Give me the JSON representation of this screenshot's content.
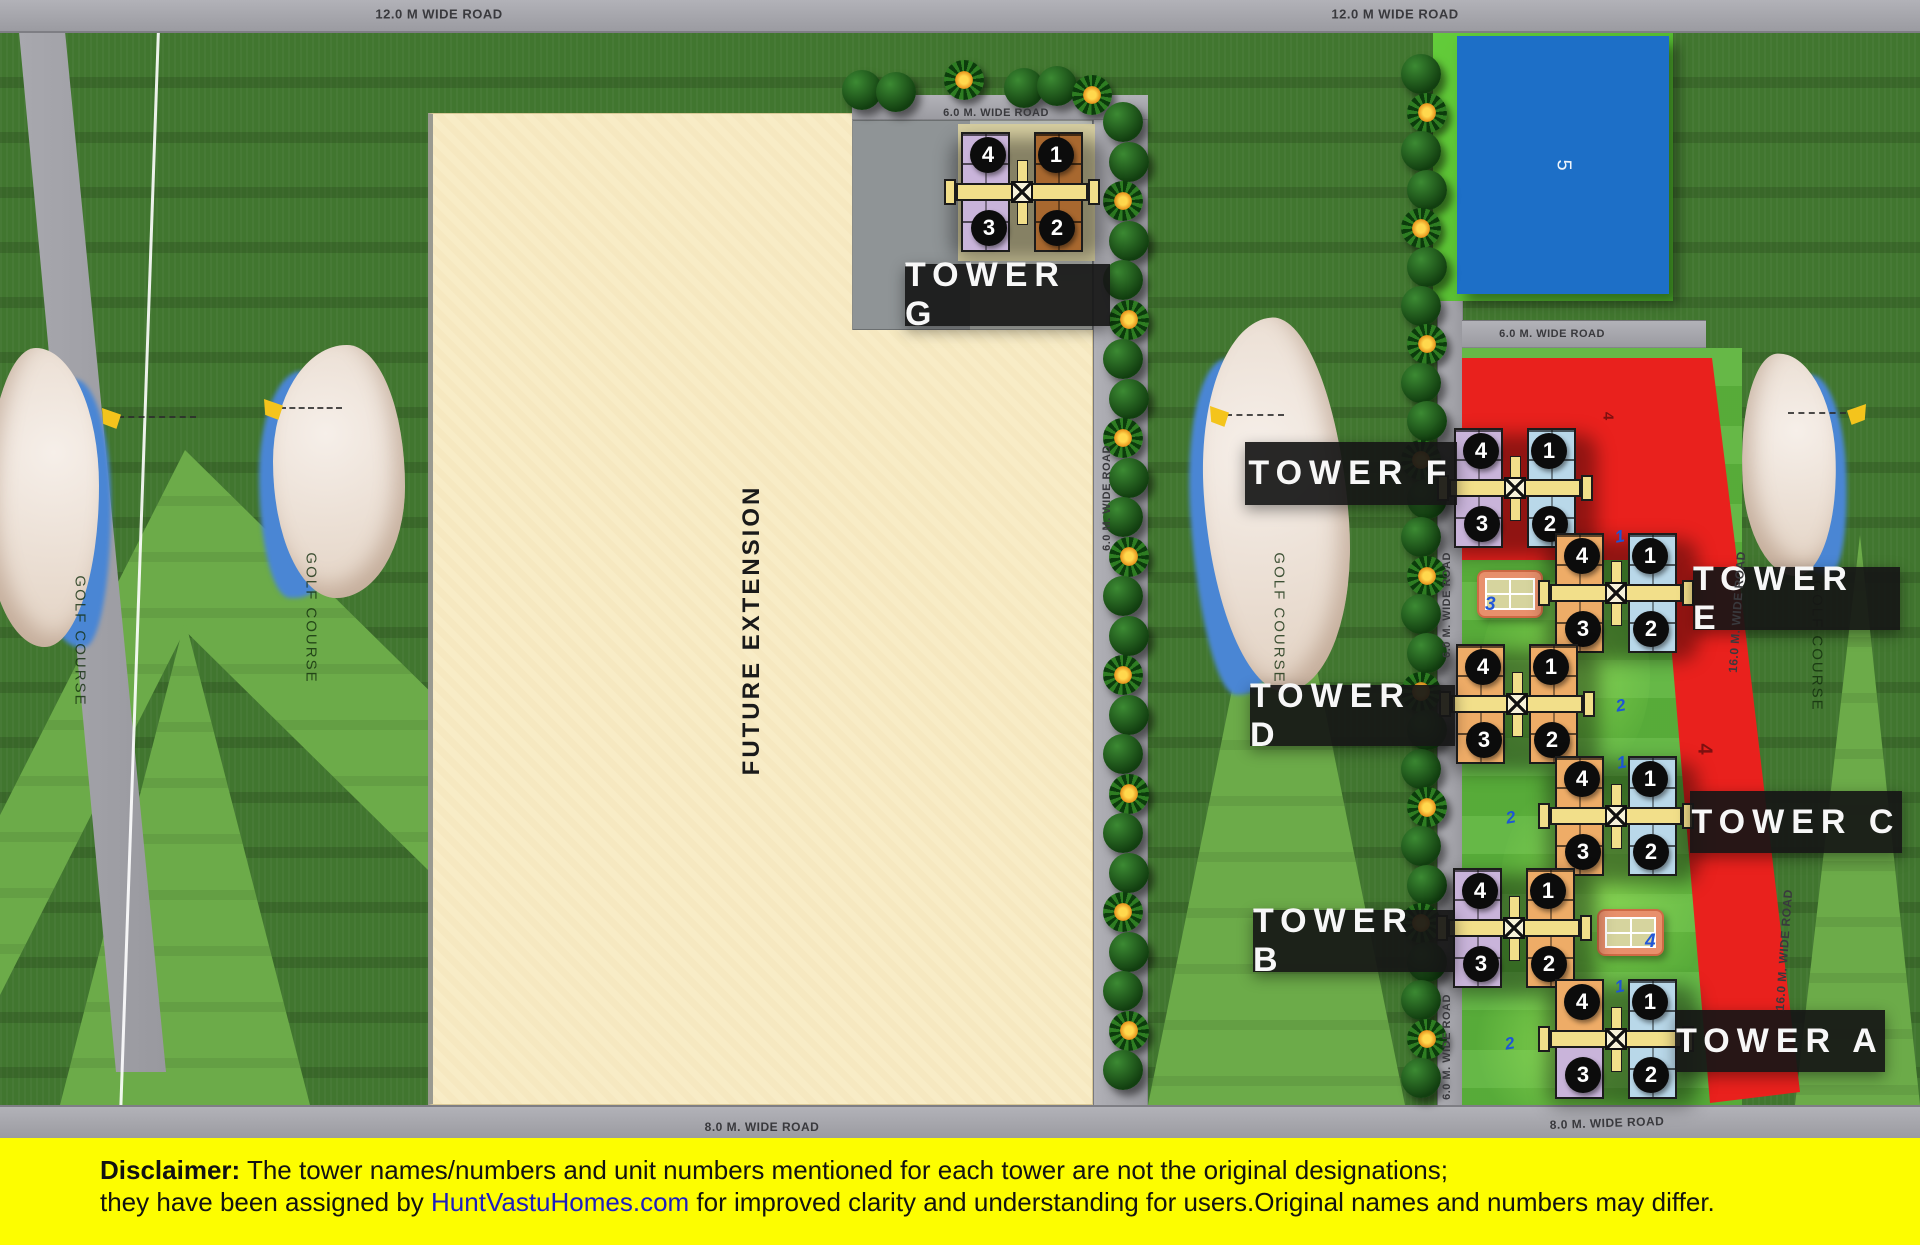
{
  "meta": {
    "width": 1920,
    "height": 1245
  },
  "colors": {
    "wings": {
      "lavender": "#c9b4da",
      "orange": "#eeac67",
      "blue": "#b9d8e9",
      "brown": "#a8682f"
    },
    "accent_red": "#e9211d",
    "pool_blue": "#1d6fc7",
    "road_gray": "#9b9ba1",
    "lawn_green": "#5cb43c",
    "grass_green": "#41762f",
    "fairway_green": "#6cab49",
    "disclaimer_yellow": "#fdfd00",
    "brand_blue": "#1d1dbf"
  },
  "areas": {
    "future_extension": "FUTURE EXTENSION",
    "golf_course": "GOLF COURSE",
    "pool_number": "5",
    "red_parcel_number": "4"
  },
  "roads": {
    "labels": [
      {
        "text": "12.0 M WIDE ROAD",
        "x": 439,
        "y": 14,
        "rot": 0,
        "size": 13
      },
      {
        "text": "12.0 M WIDE ROAD",
        "x": 1395,
        "y": 14,
        "rot": 0,
        "size": 13
      },
      {
        "text": "8.0 M. WIDE ROAD",
        "x": 762,
        "y": 1127,
        "rot": 0,
        "size": 12
      },
      {
        "text": "8.0 M. WIDE ROAD",
        "x": 1607,
        "y": 1123,
        "rot": -2,
        "size": 12
      },
      {
        "text": "6.0 M. WIDE ROAD",
        "x": 996,
        "y": 113,
        "rot": 0,
        "size": 11
      },
      {
        "text": "6.0 M. WIDE ROAD",
        "x": 1552,
        "y": 334,
        "rot": 0,
        "size": 11
      },
      {
        "text": "6.0 M. WIDE ROAD",
        "x": 1107,
        "y": 498,
        "rot": -90,
        "size": 11
      },
      {
        "text": "6.0 M. WIDE ROAD",
        "x": 1447,
        "y": 605,
        "rot": -90,
        "size": 11
      },
      {
        "text": "6.0 M. WIDE ROAD",
        "x": 1447,
        "y": 1047,
        "rot": -90,
        "size": 11
      },
      {
        "text": "16.0 M. WIDE ROAD",
        "x": 1737,
        "y": 612,
        "rot": -86,
        "size": 12
      },
      {
        "text": "16.0 M. WIDE ROAD",
        "x": 1784,
        "y": 950,
        "rot": -86,
        "size": 12
      }
    ]
  },
  "unit_numbers": [
    "4",
    "1",
    "3",
    "2"
  ],
  "unit_offsets": [
    [
      -34,
      -37
    ],
    [
      34,
      -37
    ],
    [
      -33,
      36
    ],
    [
      35,
      36
    ]
  ],
  "towers": [
    {
      "id": "G",
      "label": "TOWER G",
      "cx": 1022,
      "cy": 192,
      "left": "lavender",
      "right": "brown",
      "box": {
        "x": 905,
        "y": 264,
        "w": 205,
        "h": 62
      }
    },
    {
      "id": "F",
      "label": "TOWER F",
      "cx": 1515,
      "cy": 488,
      "left": "lavender",
      "right": "blue",
      "box": {
        "x": 1245,
        "y": 442,
        "w": 212,
        "h": 63
      }
    },
    {
      "id": "E",
      "label": "TOWER E",
      "cx": 1616,
      "cy": 593,
      "left": "orange",
      "right": "blue",
      "box": {
        "x": 1693,
        "y": 567,
        "w": 207,
        "h": 63
      }
    },
    {
      "id": "D",
      "label": "TOWER D",
      "cx": 1517,
      "cy": 704,
      "left": "orange",
      "right": "orange",
      "box": {
        "x": 1250,
        "y": 685,
        "w": 205,
        "h": 61
      }
    },
    {
      "id": "C",
      "label": "TOWER C",
      "cx": 1616,
      "cy": 816,
      "left": "orange",
      "right": "blue",
      "box": {
        "x": 1690,
        "y": 791,
        "w": 212,
        "h": 62
      }
    },
    {
      "id": "B",
      "label": "TOWER B",
      "cx": 1514,
      "cy": 928,
      "left": "lavender",
      "right": "orange",
      "box": {
        "x": 1253,
        "y": 910,
        "w": 202,
        "h": 62
      }
    },
    {
      "id": "A",
      "label": "TOWER A",
      "cx": 1616,
      "cy": 1039,
      "left": "orange",
      "left_bottom": "lavender",
      "right": "blue",
      "box": {
        "x": 1675,
        "y": 1010,
        "w": 210,
        "h": 62
      }
    }
  ],
  "lawn_numbers": [
    {
      "t": "1",
      "x": 1621,
      "y": 537
    },
    {
      "t": "2",
      "x": 1622,
      "y": 706
    },
    {
      "t": "1",
      "x": 1623,
      "y": 763
    },
    {
      "t": "2",
      "x": 1512,
      "y": 818
    },
    {
      "t": "1",
      "x": 1621,
      "y": 987
    },
    {
      "t": "2",
      "x": 1511,
      "y": 1044
    }
  ],
  "red_labels": [
    {
      "x": 1704,
      "y": 749,
      "s": 20
    },
    {
      "x": 1608,
      "y": 416,
      "s": 15
    }
  ],
  "tennis_courts": [
    {
      "x": 1477,
      "y": 570,
      "w": 66,
      "h": 48,
      "num": "3",
      "nx": 6,
      "ny": 22
    },
    {
      "x": 1597,
      "y": 909,
      "w": 67,
      "h": 47,
      "num": "4",
      "nx": 46,
      "ny": 20
    }
  ],
  "landscape": {
    "tree_rows": [
      {
        "x": 1126,
        "y": 122,
        "step": 39.5,
        "count": 25
      },
      {
        "x": 1424,
        "y": 74,
        "step": 38.6,
        "count": 27
      }
    ],
    "extra_trees": [
      {
        "x": 862,
        "y": 90,
        "t": "round"
      },
      {
        "x": 896,
        "y": 92,
        "t": "round"
      },
      {
        "x": 964,
        "y": 80,
        "t": "palm"
      },
      {
        "x": 1024,
        "y": 88,
        "t": "round"
      },
      {
        "x": 1057,
        "y": 86,
        "t": "round"
      },
      {
        "x": 1092,
        "y": 95,
        "t": "palm"
      }
    ],
    "bunkers": [
      {
        "x": -14,
        "y": 348,
        "w": 120,
        "h": 305,
        "flip": true,
        "rot": 0
      },
      {
        "x": 265,
        "y": 345,
        "w": 140,
        "h": 258,
        "flip": false,
        "rot": 0
      },
      {
        "x": 1196,
        "y": 318,
        "w": 152,
        "h": 382,
        "flip": false,
        "rot": -4
      },
      {
        "x": 1742,
        "y": 353,
        "w": 100,
        "h": 228,
        "flip": true,
        "rot": 3
      }
    ],
    "flags": [
      {
        "x": 102,
        "y": 408,
        "dir": "right",
        "len": 78
      },
      {
        "x": 264,
        "y": 399,
        "dir": "right",
        "len": 62
      },
      {
        "x": 1210,
        "y": 406,
        "dir": "right",
        "len": 58
      },
      {
        "x": 1846,
        "y": 404,
        "dir": "left",
        "len": 58
      }
    ],
    "golf_labels": [
      {
        "x": 80,
        "y": 641
      },
      {
        "x": 311,
        "y": 618
      },
      {
        "x": 1279,
        "y": 618
      },
      {
        "x": 1817,
        "y": 646
      }
    ]
  },
  "disclaimer": {
    "heading": "Disclaimer:",
    "line1": " The tower names/numbers and unit numbers mentioned for each tower are not the original designations;",
    "line2_pre": "they have been assigned by ",
    "brand": "HuntVastuHomes.com",
    "line2_post": " for improved clarity and understanding for users.Original names and numbers may differ."
  }
}
